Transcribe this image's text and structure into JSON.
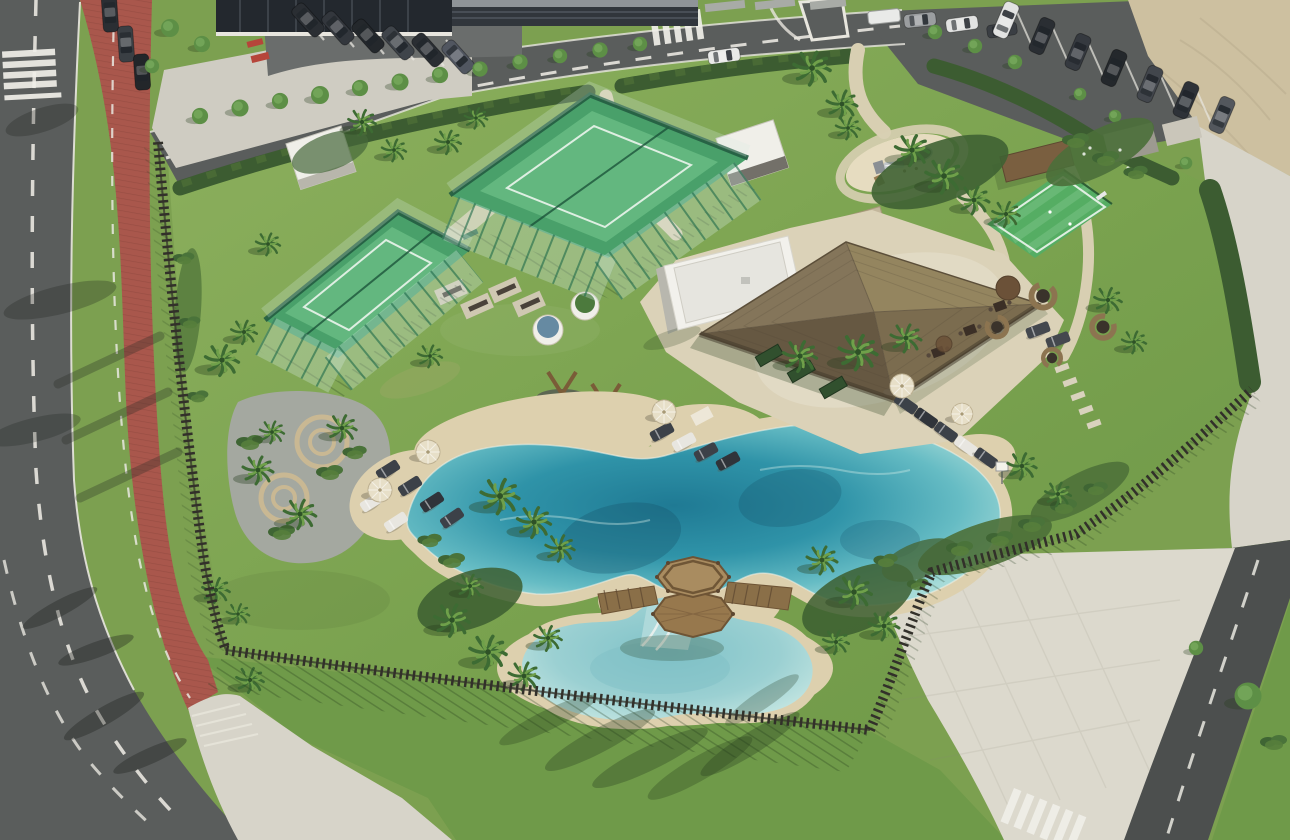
{
  "scene": {
    "type": "aerial-render-photo",
    "description": "Bird's-eye 3D render of a resort amenity parcel: lagoon-style swimming pool with sandy beach edges, a smaller kids pool joined by a wooden octagonal gazebo deck with slide channel, a clubhouse with a large thatched pyramid roof, two fenced padel courts, an outdoor gym, a playground with a mini sports court, rattan lounge pods, many palm trees, a curved boulevard with a red bike lane on the left, and parking lots with cars at the top and right.",
    "time_of_day": "sunny daytime, long shadows toward lower-left",
    "visible_text": ""
  },
  "features": [
    {
      "name": "lagoon-pool",
      "count": 1
    },
    {
      "name": "kids-pool",
      "count": 1
    },
    {
      "name": "gazebo-deck",
      "count": 1
    },
    {
      "name": "clubhouse-thatched-roof",
      "count": 1
    },
    {
      "name": "padel-court",
      "count": 2
    },
    {
      "name": "mini-sports-court",
      "count": 1
    },
    {
      "name": "playground",
      "count": 1
    },
    {
      "name": "outdoor-gym-station",
      "count": 4
    },
    {
      "name": "rattan-lounge-pod",
      "count": 4
    },
    {
      "name": "sun-lounger",
      "count": 16
    },
    {
      "name": "parasol-umbrella",
      "count": 6
    },
    {
      "name": "palm-tree",
      "count": 38
    },
    {
      "name": "parked-car",
      "count": 27
    },
    {
      "name": "bike-lane",
      "count": 1
    },
    {
      "name": "slat-fence-perimeter",
      "count": 1
    },
    {
      "name": "fire-pit-seating-circle",
      "count": 2
    }
  ],
  "palette": {
    "asphalt": "#5a5d5c",
    "asphalt_dark": "#4c4f4e",
    "road_line": "#e9e7e0",
    "bike_lane": "#a9574c",
    "sidewalk": "#d7d4c9",
    "plaza": "#dcd9cd",
    "sand_lot": "#cdc0a0",
    "lawn": "#7fa653",
    "lawn_dark": "#6f9a49",
    "hedge": "#3c5c31",
    "fence": "#32302a",
    "shadow": "#243c1c",
    "court_green": "#49a06a",
    "court_green_light": "#63b77f",
    "court_line": "#e8f3ea",
    "court_fence": "#1f6b4a",
    "path": "#d8cfb2",
    "gravel": "#a4a8a0",
    "thatch": "#84755a",
    "thatch_light": "#94855f",
    "thatch_dark": "#665842",
    "building_white": "#f2f1ec",
    "water_deep": "#1f7a94",
    "water_mid": "#2f93a8",
    "water_light": "#66bcc4",
    "water_pale": "#a6dbd8",
    "pool_sand": "#ddd0ae",
    "wood": "#9b7d52",
    "wood_dark": "#6e5435",
    "palm_dark": "#3d6b33",
    "palm_light": "#6fa04a",
    "tree_green": "#5d8f46",
    "car_dark": "#282c31",
    "car_white": "#e9eae8",
    "umbrella": "#e7dfc8",
    "pod_rattan": "#8c7450",
    "accent_red": "#b6453a"
  }
}
